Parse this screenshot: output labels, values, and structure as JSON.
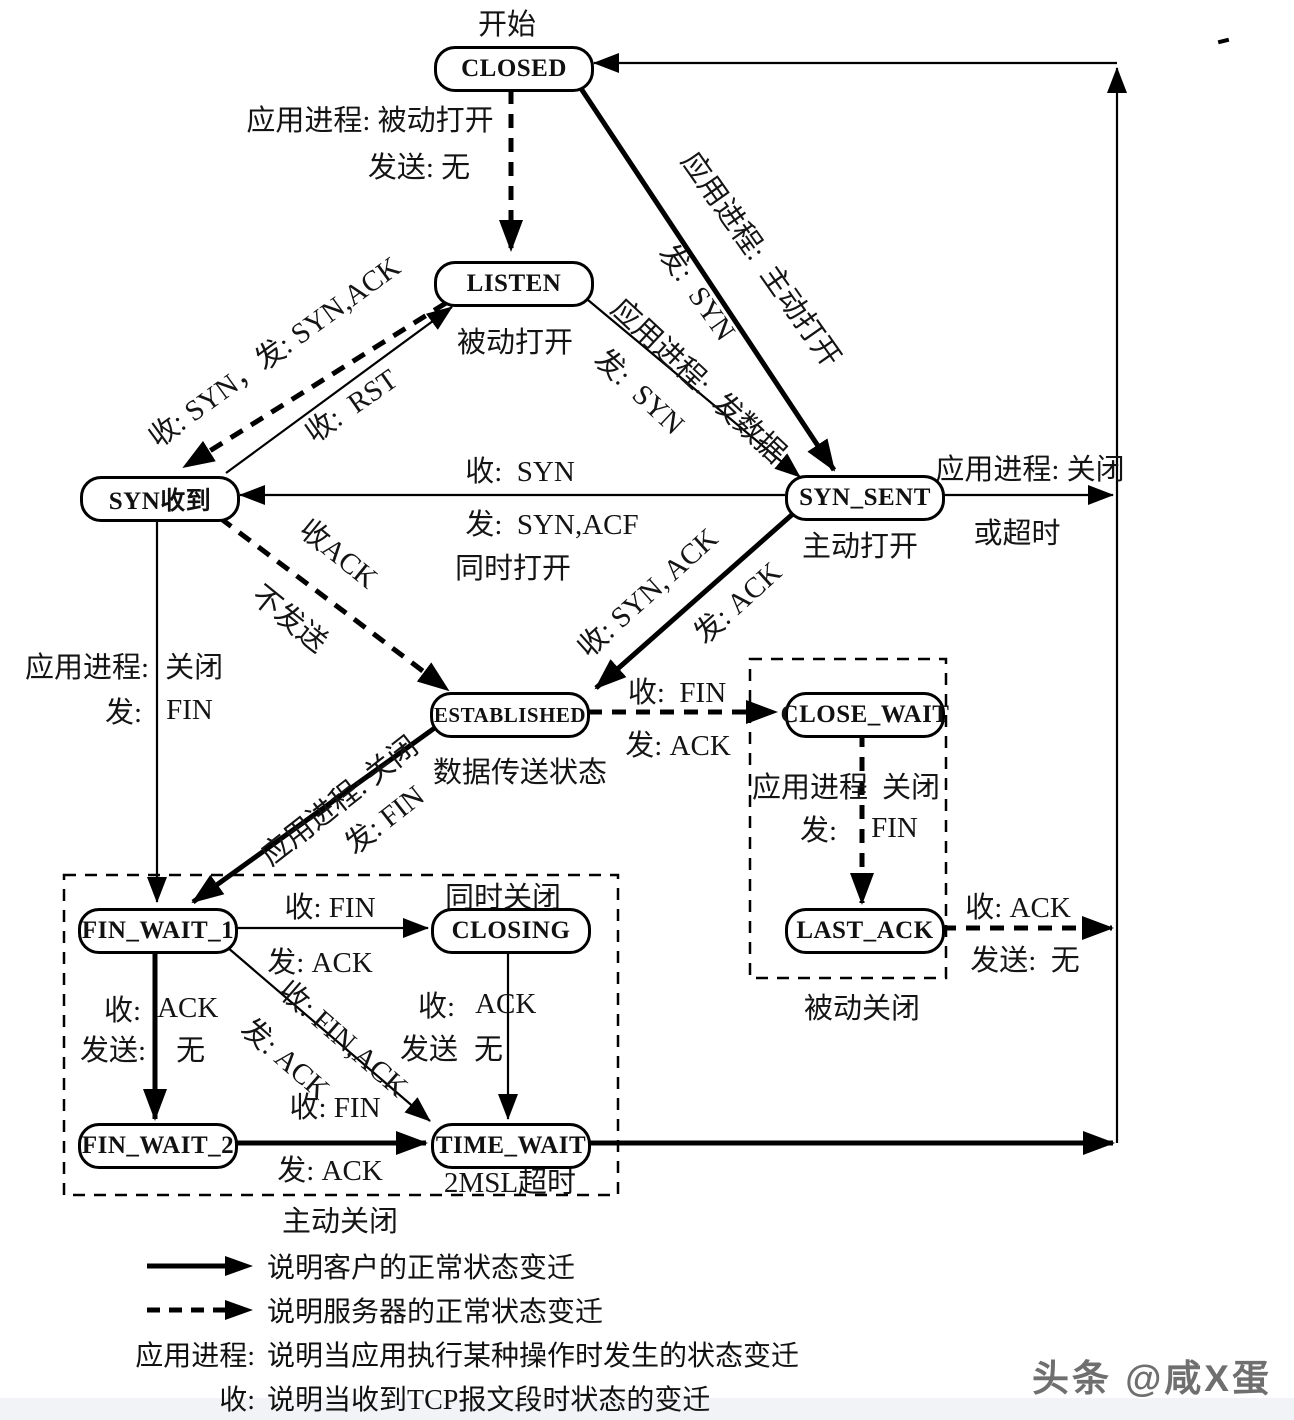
{
  "nodes": {
    "closed": "CLOSED",
    "listen": "LISTEN",
    "syn_rcvd": "SYN收到",
    "syn_sent": "SYN_SENT",
    "established": "ESTABLISHED",
    "close_wait": "CLOSE_WAIT",
    "last_ack": "LAST_ACK",
    "fin_wait_1": "FIN_WAIT_1",
    "closing": "CLOSING",
    "fin_wait_2": "FIN_WAIT_2",
    "time_wait": "TIME_WAIT"
  },
  "labels": {
    "start": "开始",
    "app_passive_open": "应用进程: 被动打开",
    "send_none_top": "发送: 无",
    "passive_open_note": "被动打开",
    "recv_syn": "收:  SYN",
    "send_syn_acf": "发:  SYN,ACF",
    "simul_open": "同时打开",
    "active_open_note": "主动打开",
    "ss_close_1": "应用进程: 关闭",
    "ss_close_2": "或超时",
    "left_app": "应用进程:",
    "left_close": "关闭",
    "left_send": "发:",
    "left_fin": "FIN",
    "data_transfer_note": "数据传送状态",
    "est_cw_recv_fin": "收:  FIN",
    "est_cw_send_ack": "发: ACK",
    "cw_app": "应用进程",
    "cw_close": "关闭",
    "cw_send": "发:",
    "cw_fin": "FIN",
    "passive_close_note": "被动关闭",
    "la_recv_ack": "收: ACK",
    "la_send_none": "发送:  无",
    "simul_close": "同时关闭",
    "fw1_closing_recv_fin": "收: FIN",
    "fw1_closing_send_ack": "发: ACK",
    "fw12_recv": "收:",
    "fw12_ack": "ACK",
    "fw12_send": "发送:",
    "fw12_none": "无",
    "cltw_recv": "收:",
    "cltw_ack": "ACK",
    "cltw_send": "发送",
    "cltw_none": "无",
    "fw2tw_recv_fin": "收: FIN",
    "fw2tw_send_ack": "发: ACK",
    "msl_note": "2MSL超时",
    "active_close_note": "主动关闭",
    "listen_synrcvd": "收: SYN，发: SYN,ACK",
    "synrcvd_listen": "收:  RST",
    "closed_ss_app": "应用进程:  主动打开",
    "closed_ss_send": "发:  SYN",
    "listen_ss_app": "应用进程:  发数据",
    "listen_ss_send": "发:  SYN",
    "synrcvd_est_recv": "收ACK",
    "synrcvd_est_send": "不发送",
    "ss_est_recv": "收: SYN, ACK",
    "ss_est_send": "发: ACK",
    "est_fw1_app": "应用进程: 关闭",
    "est_fw1_send": "发: FIN"
  },
  "legend": {
    "rows": [
      {
        "key": "",
        "text": "说明客户的正常状态变迁"
      },
      {
        "key": "",
        "text": "说明服务器的正常状态变迁"
      },
      {
        "key": "应用进程:",
        "text": "说明当应用执行某种操作时发生的状态变迁"
      },
      {
        "key": "收:",
        "text": "说明当收到TCP报文段时状态的变迁"
      },
      {
        "key": "发:",
        "text": "说明为了进行某个状态变迁要发送的TCP报文段"
      }
    ]
  },
  "watermark": "头条 @咸X蛋"
}
